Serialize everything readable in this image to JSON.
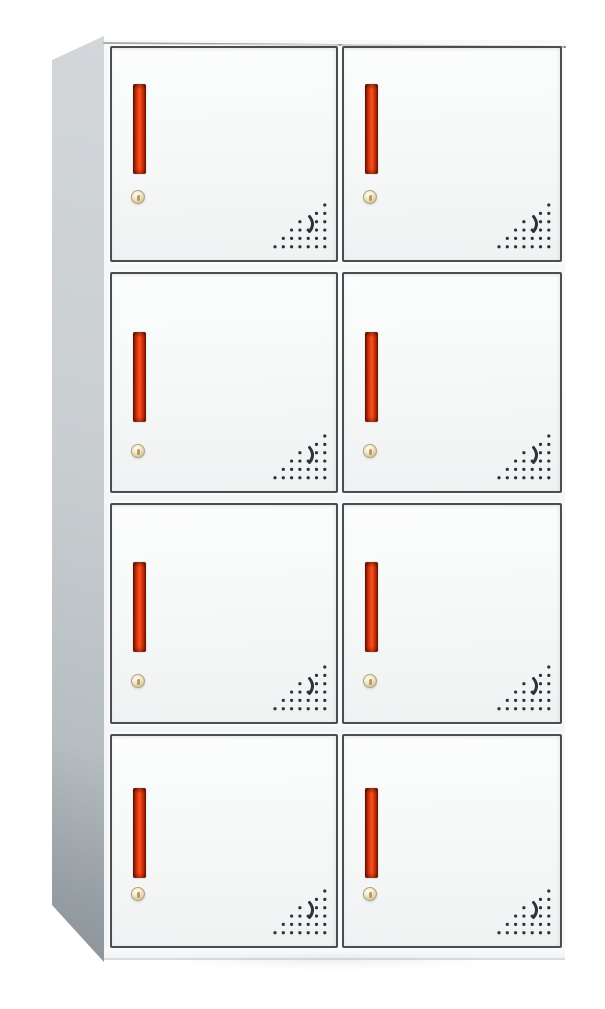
{
  "scene": {
    "subject": "white 8-door metal locker cabinet with red recessed handles, keyholes and perforated vent patterns",
    "background_color": "#ffffff",
    "visible_text": []
  },
  "cabinet": {
    "grid_rows": 4,
    "grid_cols": 2,
    "door_count": 8,
    "colors": {
      "door_face_light": "#fcfdfd",
      "door_face_shade": "#eff1f2",
      "door_frame": "#4a4e53",
      "front_panel_bg": "#f2f4f5",
      "side_panel_light": "#d3d7da",
      "side_panel_dark": "#a9b1b6",
      "handle_red_bright": "#f4551f",
      "handle_red_mid": "#d63410",
      "handle_red_dark": "#7c1503",
      "lock_beige_light": "#fffdf2",
      "lock_beige_mid": "#ddd2ae",
      "lock_beige_dark": "#b9ab83",
      "lock_keyhole": "#bb8a48",
      "vent_dot": "#2f3337"
    },
    "layout": {
      "stage": {
        "width": 605,
        "height": 1009
      },
      "side_panel": {
        "left": 52,
        "top": 36,
        "width": 52,
        "height": 926,
        "top_taper": 24,
        "bottom_taper": 57
      },
      "front": {
        "left": 104,
        "top": 40,
        "width": 461,
        "height": 920
      },
      "base_strip": {
        "top": 908,
        "height": 12
      },
      "rows": [
        {
          "top": 6,
          "height": 216,
          "handle_top": 36,
          "lock_top": 142
        },
        {
          "top": 232,
          "height": 221,
          "handle_top": 58,
          "lock_top": 170
        },
        {
          "top": 463,
          "height": 221,
          "handle_top": 57,
          "lock_top": 169
        },
        {
          "top": 694,
          "height": 214,
          "handle_top": 52,
          "lock_top": 151
        }
      ],
      "cols": [
        {
          "left": 6,
          "width": 228
        },
        {
          "left": 238,
          "width": 220
        }
      ],
      "handle": {
        "left": 21,
        "width": 13,
        "height": 90
      },
      "lock": {
        "left": 19,
        "size": 14
      },
      "vent": {
        "right": 9,
        "bottom": 10,
        "width": 55,
        "height": 50
      }
    },
    "vent_pattern": {
      "dot_rows": [
        [
          7
        ],
        [
          6,
          7
        ],
        [
          4,
          6,
          7
        ],
        [
          3,
          4,
          5,
          6,
          7
        ],
        [
          2,
          3,
          4,
          5,
          6,
          7
        ],
        [
          1,
          2,
          3,
          4,
          5,
          6,
          7
        ]
      ],
      "col_start_x": 3,
      "col_spacing": 8.3,
      "row_start_y": 5,
      "row_spacing": 8.35,
      "dot_radius": 1.6,
      "crescent_path": "M37.5,16.5 Q43.5,24 37.5,31.5"
    }
  }
}
